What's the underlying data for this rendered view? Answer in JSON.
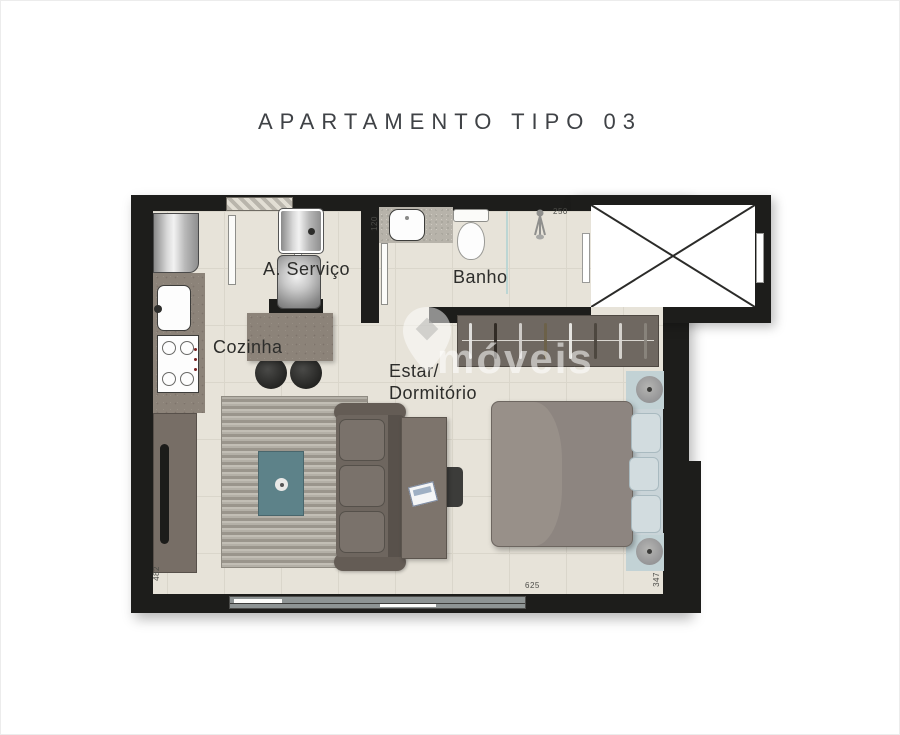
{
  "title": "APARTAMENTO TIPO 03",
  "rooms": {
    "servico_label": "A. Serviço",
    "banho_label": "Banho",
    "cozinha_label": "Cozinha",
    "estar_label_line1": "Estar/",
    "estar_label_line2": "Dormitório"
  },
  "dimensions": {
    "banho_vanity": "120",
    "banho_width": "250",
    "living_left": "482",
    "living_bottom": "625",
    "bedroom_right": "347"
  },
  "watermark": {
    "text": "móveis"
  },
  "closet": {
    "hangers": [
      "#e8e8e6",
      "#2b2621",
      "#d6d4d0",
      "#6b6148",
      "#efefec",
      "#4a443d",
      "#dcdad6",
      "#8a857e"
    ]
  },
  "colors": {
    "wall": "#1d1d1b",
    "floor": "#e7e3d9",
    "counter_granite": "#8c8379",
    "coffee_table_teal": "#5d8289",
    "sofa": "#6e665f",
    "bed_duvet": "#8d8580",
    "pillow_blue": "#d2dcdf",
    "wardrobe": "#6f6861"
  }
}
